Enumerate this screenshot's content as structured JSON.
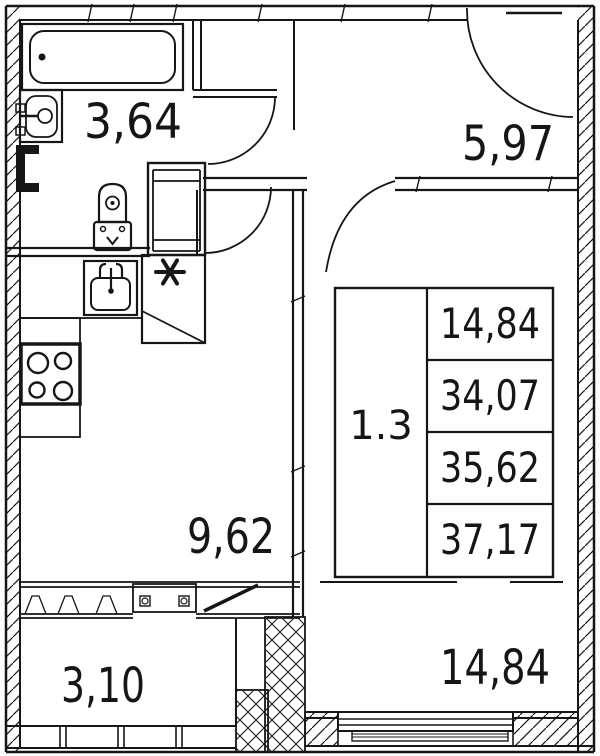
{
  "plan_type": "apartment-floor-plan",
  "colors": {
    "line": "#161616",
    "background": "#ffffff"
  },
  "rooms": {
    "bathroom": {
      "area": "3,64"
    },
    "hallway": {
      "area": "5,97"
    },
    "kitchen": {
      "area": "9,62"
    },
    "balcony": {
      "area": "3,10"
    },
    "living_room": {
      "area": "14,84"
    }
  },
  "stamp": {
    "type": "1.3",
    "values": [
      "14,84",
      "34,07",
      "35,62",
      "37,17"
    ]
  },
  "symbols": {
    "vent": "ventilation-asterisk",
    "fixtures": [
      "bathtub",
      "wash-basin",
      "toilet",
      "kitchen-sink",
      "stove"
    ]
  }
}
